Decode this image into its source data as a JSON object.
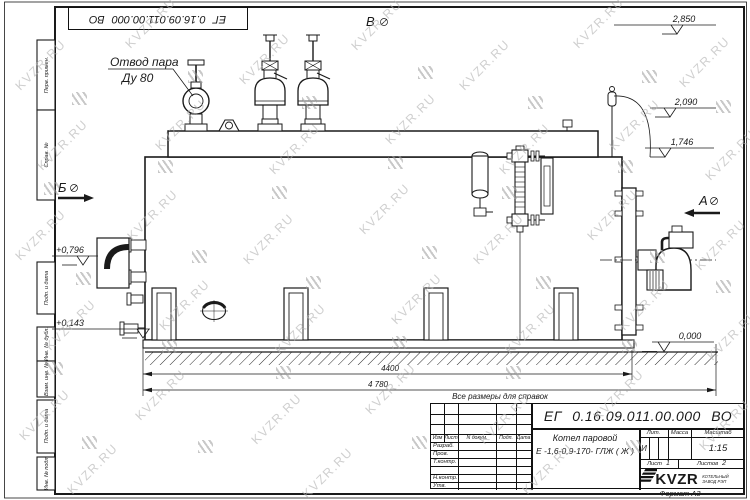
{
  "watermark": {
    "text": "KVZR.RU"
  },
  "stamp_top_left": {
    "text": "ЕГ 0.16.09.011.00.000 ВО"
  },
  "frame": {
    "margin_labels": [
      "Перв. примен.",
      "Справ. №",
      "Подп. и дата",
      "Инв. № дубл.",
      "Взам. инв. №",
      "Подп. и дата",
      "Инв. № подл."
    ],
    "format_label": "Формат А3"
  },
  "drawing": {
    "steam_outlet": {
      "line1": "Отвод пара",
      "line2": "Ду 80"
    },
    "views": {
      "a": "А",
      "b": "Б",
      "v": "В"
    },
    "levels": {
      "top": "2,850",
      "drum": "2,090",
      "shell": "1,746",
      "left_upper": "+0,796",
      "left_lower": "+0,143",
      "ground": "0,000"
    },
    "dims": {
      "base": "4400",
      "overall": "4 780"
    },
    "note": "Все размеры для справок"
  },
  "title_block": {
    "doc_number": "ЕГ 0.16.09.011.00.000 ВО",
    "name_line1": "Котел паровой",
    "name_line2": "Е -1,6-0,9-170- ГЛЖ ( Ж )",
    "cols": {
      "izm": "Изм",
      "list": "Лист",
      "doc": "N докум.",
      "sign": "Подп.",
      "date": "Дата"
    },
    "rows": [
      "Разраб.",
      "Пров.",
      "Т.контр.",
      "",
      "Н.контр.",
      "Утв."
    ],
    "lit_label": "Лит.",
    "mass_label": "Масса",
    "scale_label": "Масштаб",
    "lit_value": "И",
    "scale_value": "1:15",
    "sheet_label": "Лист",
    "sheet_value": "1",
    "sheets_label": "Листов",
    "sheets_value": "2",
    "logo_text": "KVZR",
    "logo_sub1": "КОТЕЛЬНЫЙ",
    "logo_sub2": "ЗАВОД РЭП"
  }
}
